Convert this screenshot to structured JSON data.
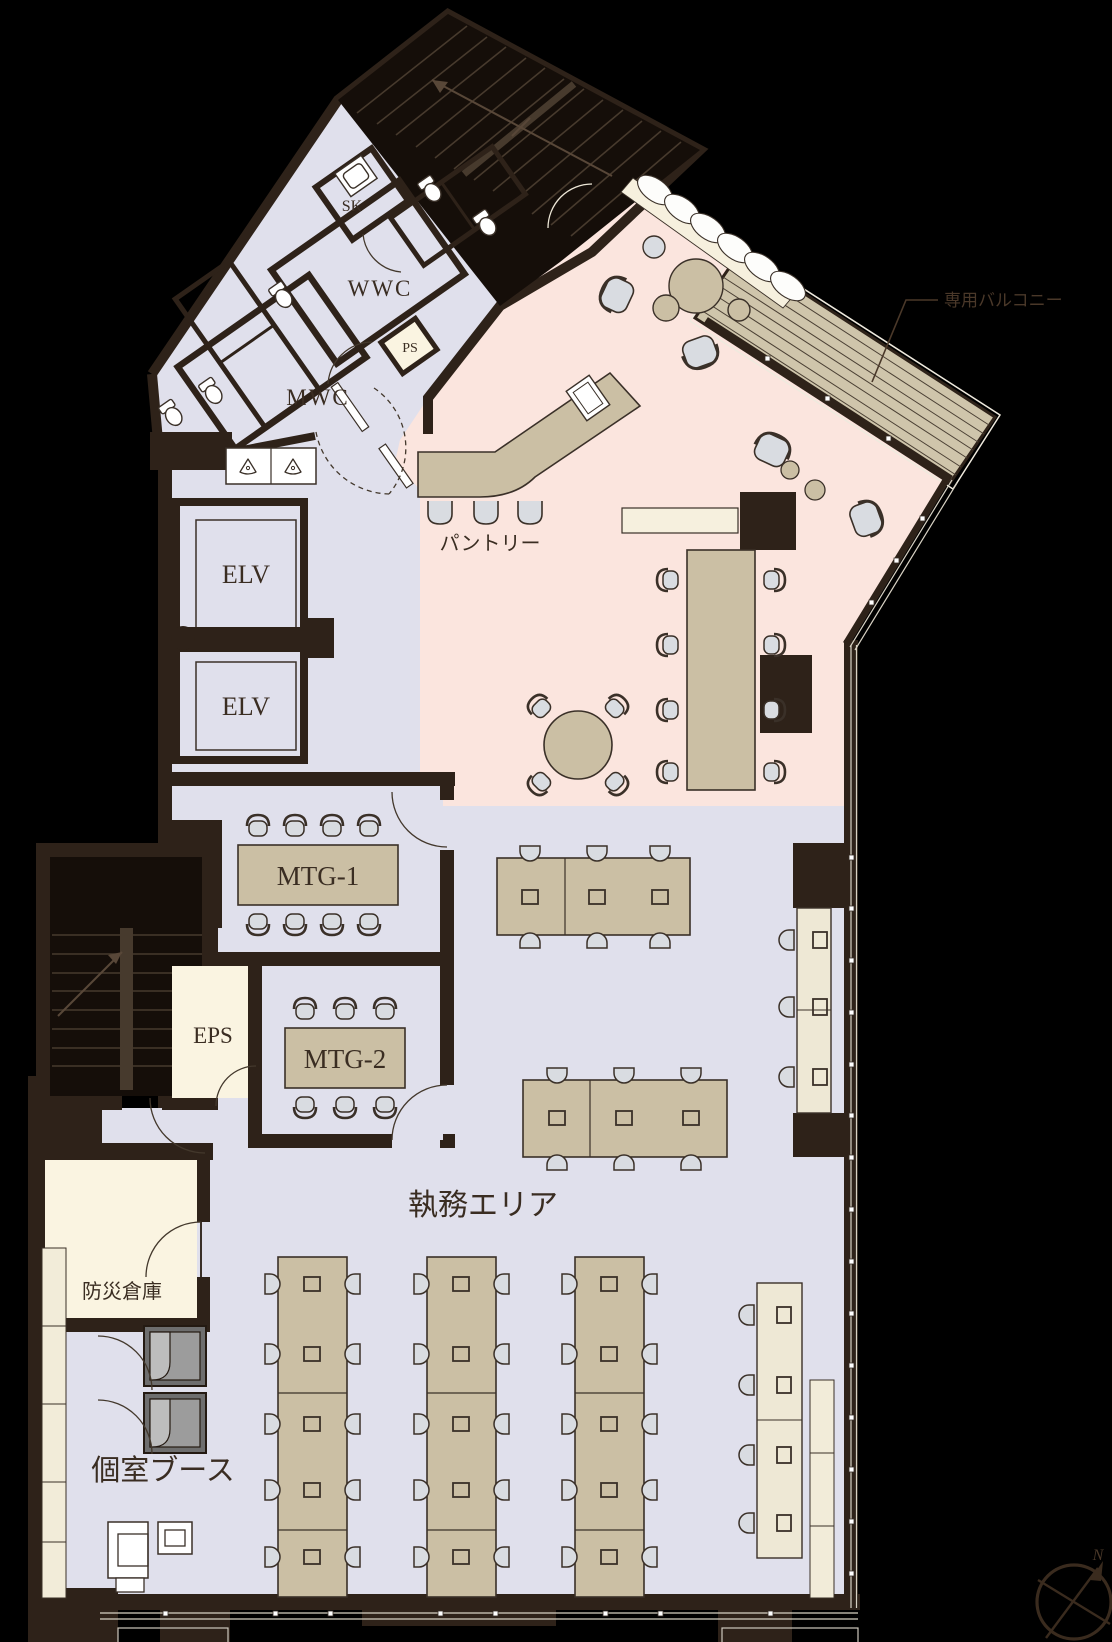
{
  "labels": {
    "sk": "SK",
    "wwc": "WWC",
    "mwc": "MWC",
    "ps": "PS",
    "elv1": "ELV",
    "elv2": "ELV",
    "pantry": "パントリー",
    "balcony": "専用バルコニー",
    "mtg1": "MTG-1",
    "mtg2": "MTG-2",
    "eps": "EPS",
    "work_area": "執務エリア",
    "disaster_storage": "防災倉庫",
    "private_booth": "個室ブース",
    "north": "N"
  },
  "colors": {
    "background": "#000000",
    "wall": "#2e2219",
    "floor_common": "#e0e0ec",
    "floor_lounge": "#fbe5de",
    "floor_service": "#faf4e1",
    "furniture_wood": "#cbbfa4",
    "desk_light": "#eee8d5",
    "balcony_deck": "#cfc5ab",
    "chair": "#d9dce1"
  }
}
